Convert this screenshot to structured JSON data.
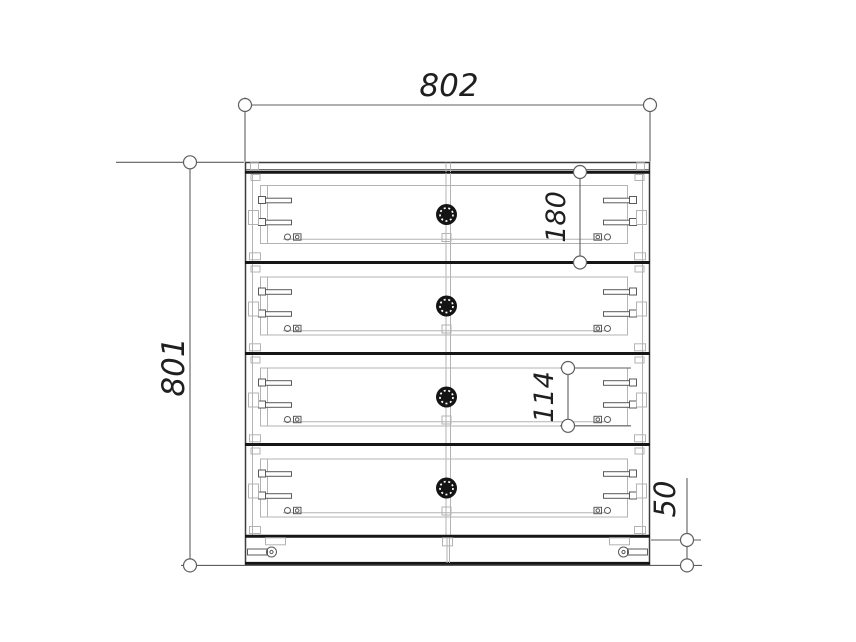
{
  "drawing": {
    "title": "Chest of drawers - front view technical drawing",
    "object": "4-drawer chest",
    "view": "front",
    "units": "mm",
    "drawer_count": 4,
    "dimensions": {
      "overall_width": "802",
      "overall_height": "801",
      "drawer_front_height": "180",
      "drawer_box_side_height": "114",
      "plinth_height": "50"
    },
    "colors": {
      "background": "#ffffff",
      "line_heavy": "#161616",
      "line_outline": "#3d3d3d",
      "line_medium": "#5a5a5a",
      "line_light": "#b3b3b3",
      "dimension": "#5f5f5f",
      "text": "#1f1f1f",
      "knob": "#141414"
    }
  }
}
